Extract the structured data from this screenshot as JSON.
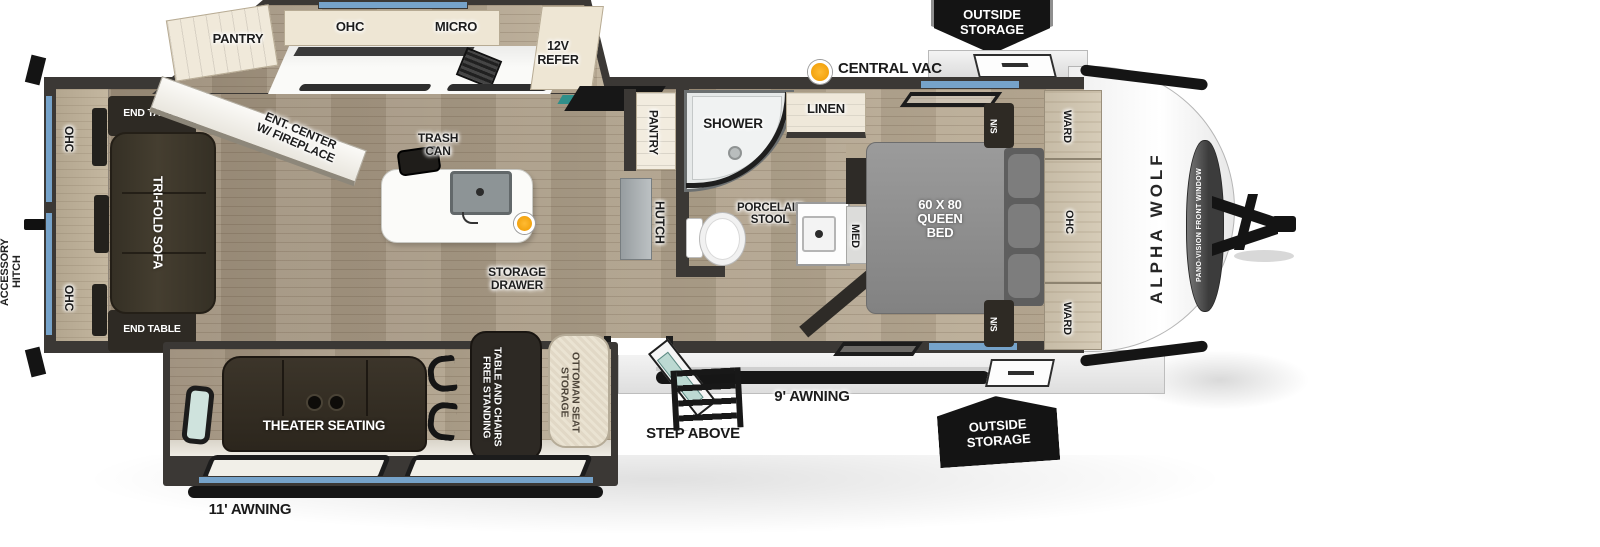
{
  "colors": {
    "wall": "#3b3835",
    "floor_wood": "#a3947f",
    "cabinet_cream": "#eee6d4",
    "furniture_dark": "#2e2a24",
    "bed_gray": "#8c8c8c",
    "window_blue": "#76a3ca",
    "accent_orange": "#f5a11c",
    "badge_black": "#141414"
  },
  "exterior": {
    "accessory_hitch_label": "ACCESSORY\nHITCH",
    "outside_storage_top": "OUTSIDE\nSTORAGE",
    "outside_storage_bottom": "OUTSIDE\nSTORAGE",
    "central_vac_label": "CENTRAL VAC",
    "awning_rear": "11' AWNING",
    "awning_front": "9' AWNING",
    "step_label": "STEP ABOVE",
    "brand": "ALPHA WOLF",
    "front_window": "PANO-VISION FRONT WINDOW"
  },
  "living_area": {
    "ohc_rear_top": "OHC",
    "ohc_rear_bottom": "OHC",
    "end_table_top": "END TABLE",
    "end_table_bottom": "END TABLE",
    "sofa": "TRI-FOLD SOFA",
    "ent_center": "ENT. CENTER\nW/ FIREPLACE",
    "theater_seating": "THEATER SEATING",
    "storage_drawer": "STORAGE\nDRAWER",
    "table": "FREE STANDING\nTABLE AND CHAIRS",
    "ottoman": "STORAGE\nOTTOMAN SEAT",
    "trash_can": "TRASH\nCAN"
  },
  "kitchen": {
    "pantry": "PANTRY",
    "ohc": "OHC",
    "micro": "MICRO",
    "refer": "12V\nREFER"
  },
  "mid_section": {
    "pantry": "PANTRY",
    "hutch": "HUTCH"
  },
  "bathroom": {
    "shower": "SHOWER",
    "stool": "PORCELAIN\nSTOOL",
    "linen": "LINEN",
    "med": "MED"
  },
  "bedroom": {
    "bed": "60 X 80\nQUEEN\nBED",
    "ns_top": "N/S",
    "ns_bottom": "N/S",
    "ward_top": "WARD",
    "ward_bottom": "WARD",
    "ohc": "OHC"
  }
}
